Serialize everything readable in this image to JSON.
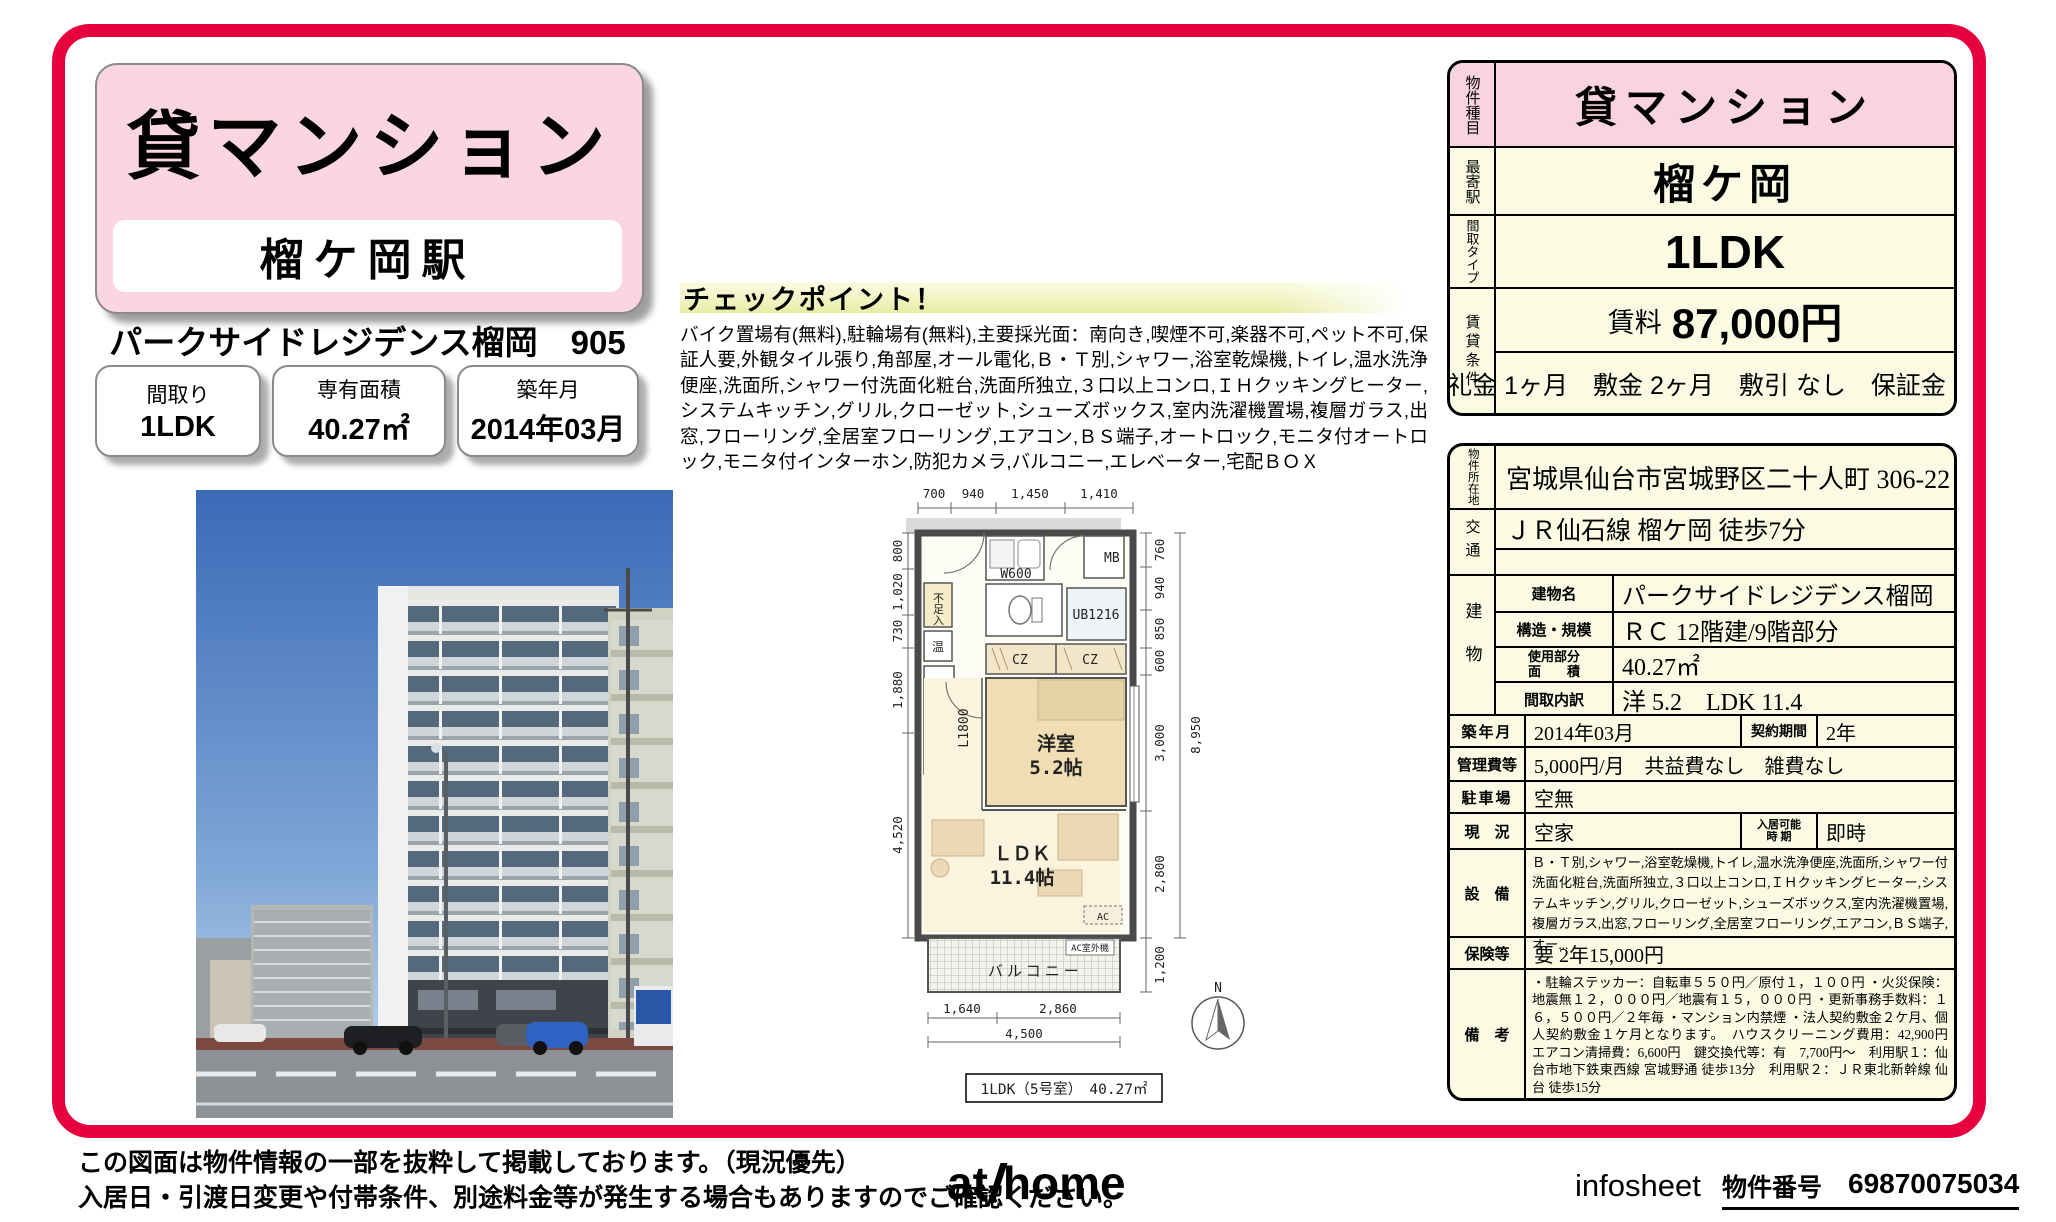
{
  "colors": {
    "frame_red": "#e6003e",
    "header_pink": "#fbd5e2",
    "table_pink": "#f9d3df",
    "table_cream": "#fbfbe4",
    "checkpoint_band": "#e7eda6"
  },
  "header": {
    "category": "貸マンション",
    "station": "榴ケ岡駅",
    "property_name": "パークサイドレジデンス榴岡　905",
    "boxes": [
      {
        "label": "間取り",
        "value": "1LDK"
      },
      {
        "label": "専有面積",
        "value": "40.27㎡"
      },
      {
        "label": "築年月",
        "value": "2014年03月"
      }
    ]
  },
  "checkpoint": {
    "title": "チェックポイント！",
    "body": "バイク置場有(無料),駐輪場有(無料),主要採光面：南向き,喫煙不可,楽器不可,ペット不可,保証人要,外観タイル張り,角部屋,オール電化,Ｂ・Ｔ別,シャワー,浴室乾燥機,トイレ,温水洗浄便座,洗面所,シャワー付洗面化粧台,洗面所独立,３口以上コンロ,ＩＨクッキングヒーター,システムキッチン,グリル,クローゼット,シューズボックス,室内洗濯機置場,複層ガラス,出窓,フローリング,全居室フローリング,エアコン,ＢＳ端子,オートロック,モニタ付オートロック,モニタ付インターホン,防犯カメラ,バルコニー,エレベーター,宅配ＢＯＸ"
  },
  "table1": {
    "r1_label": "物件種目",
    "r1_value": "貸マンション",
    "r2_label": "最寄駅",
    "r2_value": "榴ケ岡",
    "r3_label": "間取タイプ",
    "r3_value": "1LDK",
    "r4_label": "賃貸条件",
    "rent_label": "賃料",
    "rent_value": "87,000円",
    "terms": "礼金 1ヶ月　敷金 2ヶ月　敷引 なし　保証金 なし"
  },
  "table2": {
    "address_label": "物件所在地",
    "address": "宮城県仙台市宮城野区二十人町 306-22",
    "access_label": "交通",
    "access1": "ＪＲ仙石線 榴ケ岡 徒歩7分",
    "access2": "",
    "building_label": "建物",
    "b1_label": "建物名",
    "b1_value": "パークサイドレジデンス榴岡　905",
    "b2_label": "構造・規模",
    "b2_value": "ＲＣ 12階建/9階部分",
    "b3_label1": "使用部分",
    "b3_label2": "面　　積",
    "b3_value": "40.27㎡",
    "b4_label": "間取内訳",
    "b4_value": "洋 5.2　LDK 11.4",
    "built_label": "築年月",
    "built": "2014年03月",
    "contract_label": "契約期間",
    "contract": "2年",
    "fee_label": "管理費等",
    "fee": "5,000円/月　共益費なし　雑費なし",
    "parking_label": "駐車場",
    "parking": "空無",
    "status_label": "現　況",
    "status": "空家",
    "movein_label1": "入居可能",
    "movein_label2": "時 期",
    "movein": "即時",
    "equipment_label": "設　備",
    "equipment": "Ｂ・Ｔ別,シャワー,浴室乾燥機,トイレ,温水洗浄便座,洗面所,シャワー付洗面化粧台,洗面所独立,３口以上コンロ,ＩＨクッキングヒーター,システムキッチン,グリル,クローゼット,シューズボックス,室内洗濯機置場,複層ガラス,出窓,フローリング,全居室フローリング,エアコン,ＢＳ端子,オー...",
    "insurance_label": "保険等",
    "insurance": "要 2年15,000円",
    "notes_label": "備　考",
    "notes": "・駐輪ステッカー：自転車５５０円／原付１，１００円 ・火災保険：地震無１２，０００円／地震有１５，０００円 ・更新事務手数料：１６，５００円／２年毎 ・マンション内禁煙 ・法人契約敷金２ケ月、個人契約敷金１ケ月となります。　ハウスクリーニング費用：42,900円　エアコン清掃費：6,600円　鍵交換代等：有　7,700円～　利用駅１：仙台市地下鉄東西線 宮城野通 徒歩13分　利用駅２：ＪＲ東北新幹線 仙台 徒歩15分"
  },
  "floorplan": {
    "top_dims": [
      "700",
      "940",
      "1,450",
      "1,410"
    ],
    "left_dims": [
      "800",
      "1,020",
      "730",
      "1,880",
      "4,520"
    ],
    "right_dims": [
      "760",
      "940",
      "850",
      "600",
      "3,000",
      "2,800",
      "1,200"
    ],
    "right_total": "8,950",
    "bottom_dims": [
      "1,640",
      "2,860"
    ],
    "bottom_total": "4,500",
    "labels": {
      "mb": "MB",
      "w600": "W600",
      "storage": "不足入",
      "heater": "温",
      "kitchen_len": "L1800",
      "ub": "UB1216",
      "cz_left": "CZ",
      "cz_right": "CZ",
      "bedroom1": "洋室",
      "bedroom2": "5.2帖",
      "ldk1": "ＬＤＫ",
      "ldk2": "11.4帖",
      "balcony": "バルコニー",
      "ac": "AC",
      "ac_out": "AC室外機",
      "north": "N"
    },
    "caption": "1LDK（5号室）　40.27㎡"
  },
  "footer": {
    "disclaimer1": "この図面は物件情報の一部を抜粋して掲載しております。（現況優先）",
    "disclaimer2": "入居日・引渡日変更や付帯条件、別途料金等が発生する場合もありますのでご確認ください。",
    "logo_at": "at",
    "logo_home": "home",
    "infosheet": "infosheet",
    "property_no_label": "物件番号",
    "property_no": "69870075034"
  }
}
